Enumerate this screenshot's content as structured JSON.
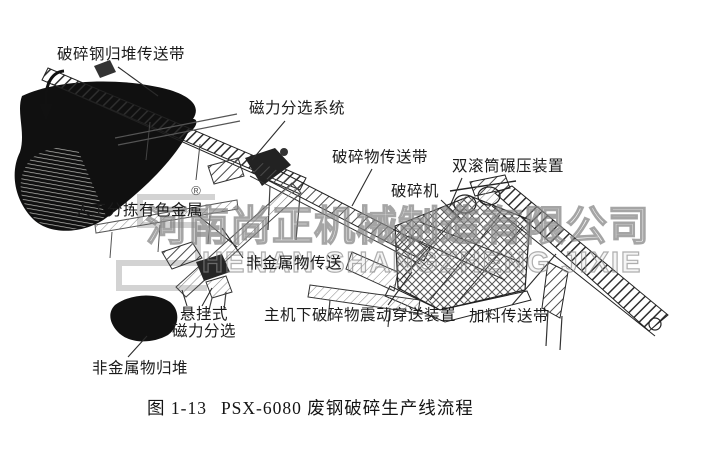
{
  "figure": {
    "caption": {
      "prefix": "图 1-13",
      "text": "PSX-6080 废钢破碎生产线流程"
    },
    "labels": {
      "crushed_steel_pile_conveyor": "破碎钢归堆传送带",
      "magnetic_separation_system": "磁力分选系统",
      "crushed_material_conveyor": "破碎物传送带",
      "crusher": "破碎机",
      "double_roller_press": "双滚筒碾压装置",
      "manual_sorting_nonferrous": "人工分拣有色金属",
      "nonmetal_conveying": "非金属物传送",
      "suspended_magnetic_line1": "悬挂式",
      "suspended_magnetic_line2": "磁力分选",
      "under_main_vibrating_conveyor": "主机下破碎物震动穿送装置",
      "feeding_conveyor": "加料传送带",
      "nonmetal_pile": "非金属物归堆"
    },
    "watermark": {
      "cn": "河南尚正机械制造有限公司",
      "en": "HENAN SHANGZHENG JIXIE",
      "registered_mark": "®"
    },
    "colors": {
      "ink": "#1c1c1c",
      "paper": "#ffffff",
      "watermark": "#a8a8a8"
    }
  }
}
